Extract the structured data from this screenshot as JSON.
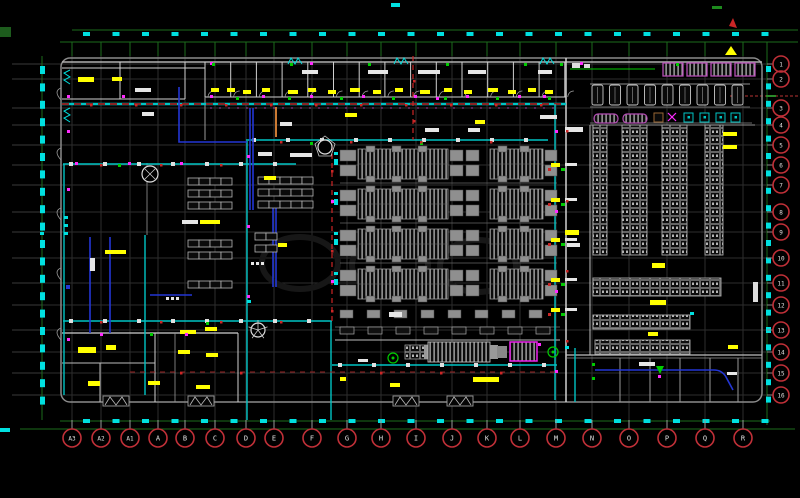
{
  "drawing": {
    "type": "cad-floor-plan",
    "description": "Electrical / equipment floor plan CAD drawing on black background with column grid bubbles",
    "column_bubbles": [
      "A3",
      "A2",
      "A1",
      "A",
      "B",
      "C",
      "D",
      "E",
      "F",
      "G",
      "H",
      "I",
      "J",
      "K",
      "L",
      "M",
      "N",
      "O",
      "P",
      "Q",
      "R"
    ],
    "row_bubbles": [
      "1",
      "2",
      "3",
      "4",
      "5",
      "6",
      "7",
      "8",
      "9",
      "10",
      "11",
      "12",
      "13",
      "14",
      "15",
      "16"
    ]
  },
  "palette": {
    "background": "#000000",
    "grid": "#2e2e2e",
    "tick_gray": "#3a3a3a",
    "frame_green": "#1d6b1d",
    "bright_green": "#00cc00",
    "cyan": "#00e0e0",
    "teal": "#00c4c4",
    "yellow": "#ffff00",
    "white": "#e6e6e6",
    "wall_gray": "#9a9a9a",
    "block_gray": "#8f8f8f",
    "blue": "#2336d4",
    "magenta": "#ff2bff",
    "purple": "#b44cb4",
    "red": "#cc2626",
    "maroon": "#8a2424",
    "orange": "#cc7a33",
    "bubble_red": "#c03038",
    "bubble_text": "#e0e0e0"
  }
}
